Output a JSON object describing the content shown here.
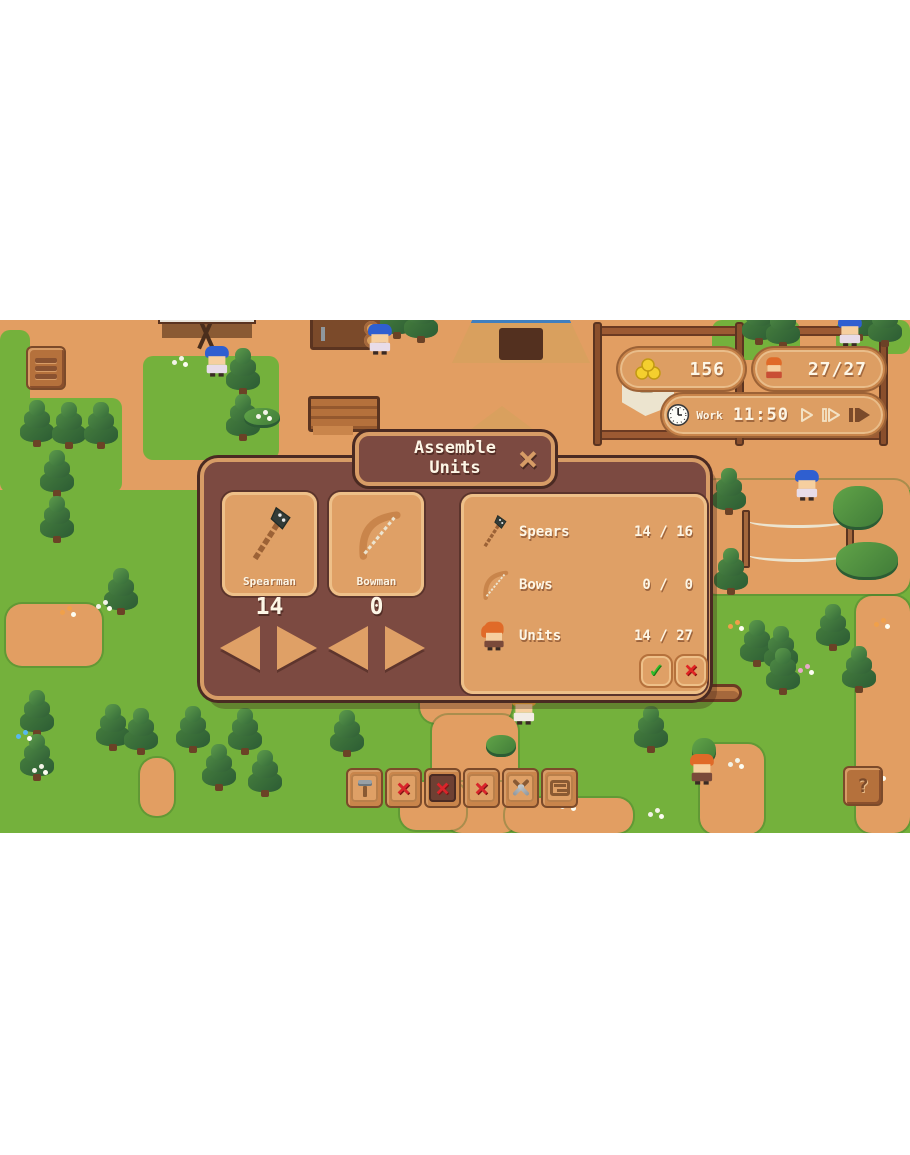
{
  "hud": {
    "menu_button": {
      "icon": "menu-bars-icon"
    },
    "resources": {
      "gold": "156",
      "population": "27/27"
    },
    "time": {
      "phase": "Work",
      "clock": "11:50",
      "speed_buttons": [
        "play",
        "fast-forward",
        "fastest"
      ]
    },
    "help_button": {
      "label": "?"
    }
  },
  "dialog": {
    "title": "Assemble Units",
    "close": "×",
    "cards": [
      {
        "name": "Spearman",
        "count": "14",
        "icon": "spear-icon"
      },
      {
        "name": "Bowman",
        "count": "0",
        "icon": "bow-icon"
      }
    ],
    "summary": [
      {
        "label": "Spears",
        "value": "14 / 16",
        "icon": "spear-icon"
      },
      {
        "label": "Bows",
        "value": "0 /  0",
        "icon": "bow-icon"
      },
      {
        "label": "Units",
        "value": "14 / 27",
        "icon": "villager-icon"
      }
    ],
    "confirm": "✓",
    "cancel": "×"
  },
  "toolbar": {
    "buttons": [
      {
        "name": "build",
        "icon": "hammer-icon",
        "selected": false
      },
      {
        "name": "cancel-option-1",
        "icon": "red-x-icon",
        "selected": false
      },
      {
        "name": "cancel-option-2",
        "icon": "red-x-icon",
        "selected": true
      },
      {
        "name": "cancel-option-3",
        "icon": "red-x-icon",
        "selected": false
      },
      {
        "name": "military",
        "icon": "crossed-swords-icon",
        "selected": false
      },
      {
        "name": "structures",
        "icon": "wood-frame-icon",
        "selected": false
      }
    ]
  },
  "colors": {
    "grass": "#74b13c",
    "dirt": "#e29e62",
    "dialog_bg": "#7c4a41",
    "panel_tan": "#dfa066",
    "frame_tan": "#d79c66",
    "text_cream": "#fdf6e6",
    "confirm_green": "#2fbe2a",
    "cancel_red": "#d9252b",
    "gold_coin": "#f4cf2e"
  }
}
